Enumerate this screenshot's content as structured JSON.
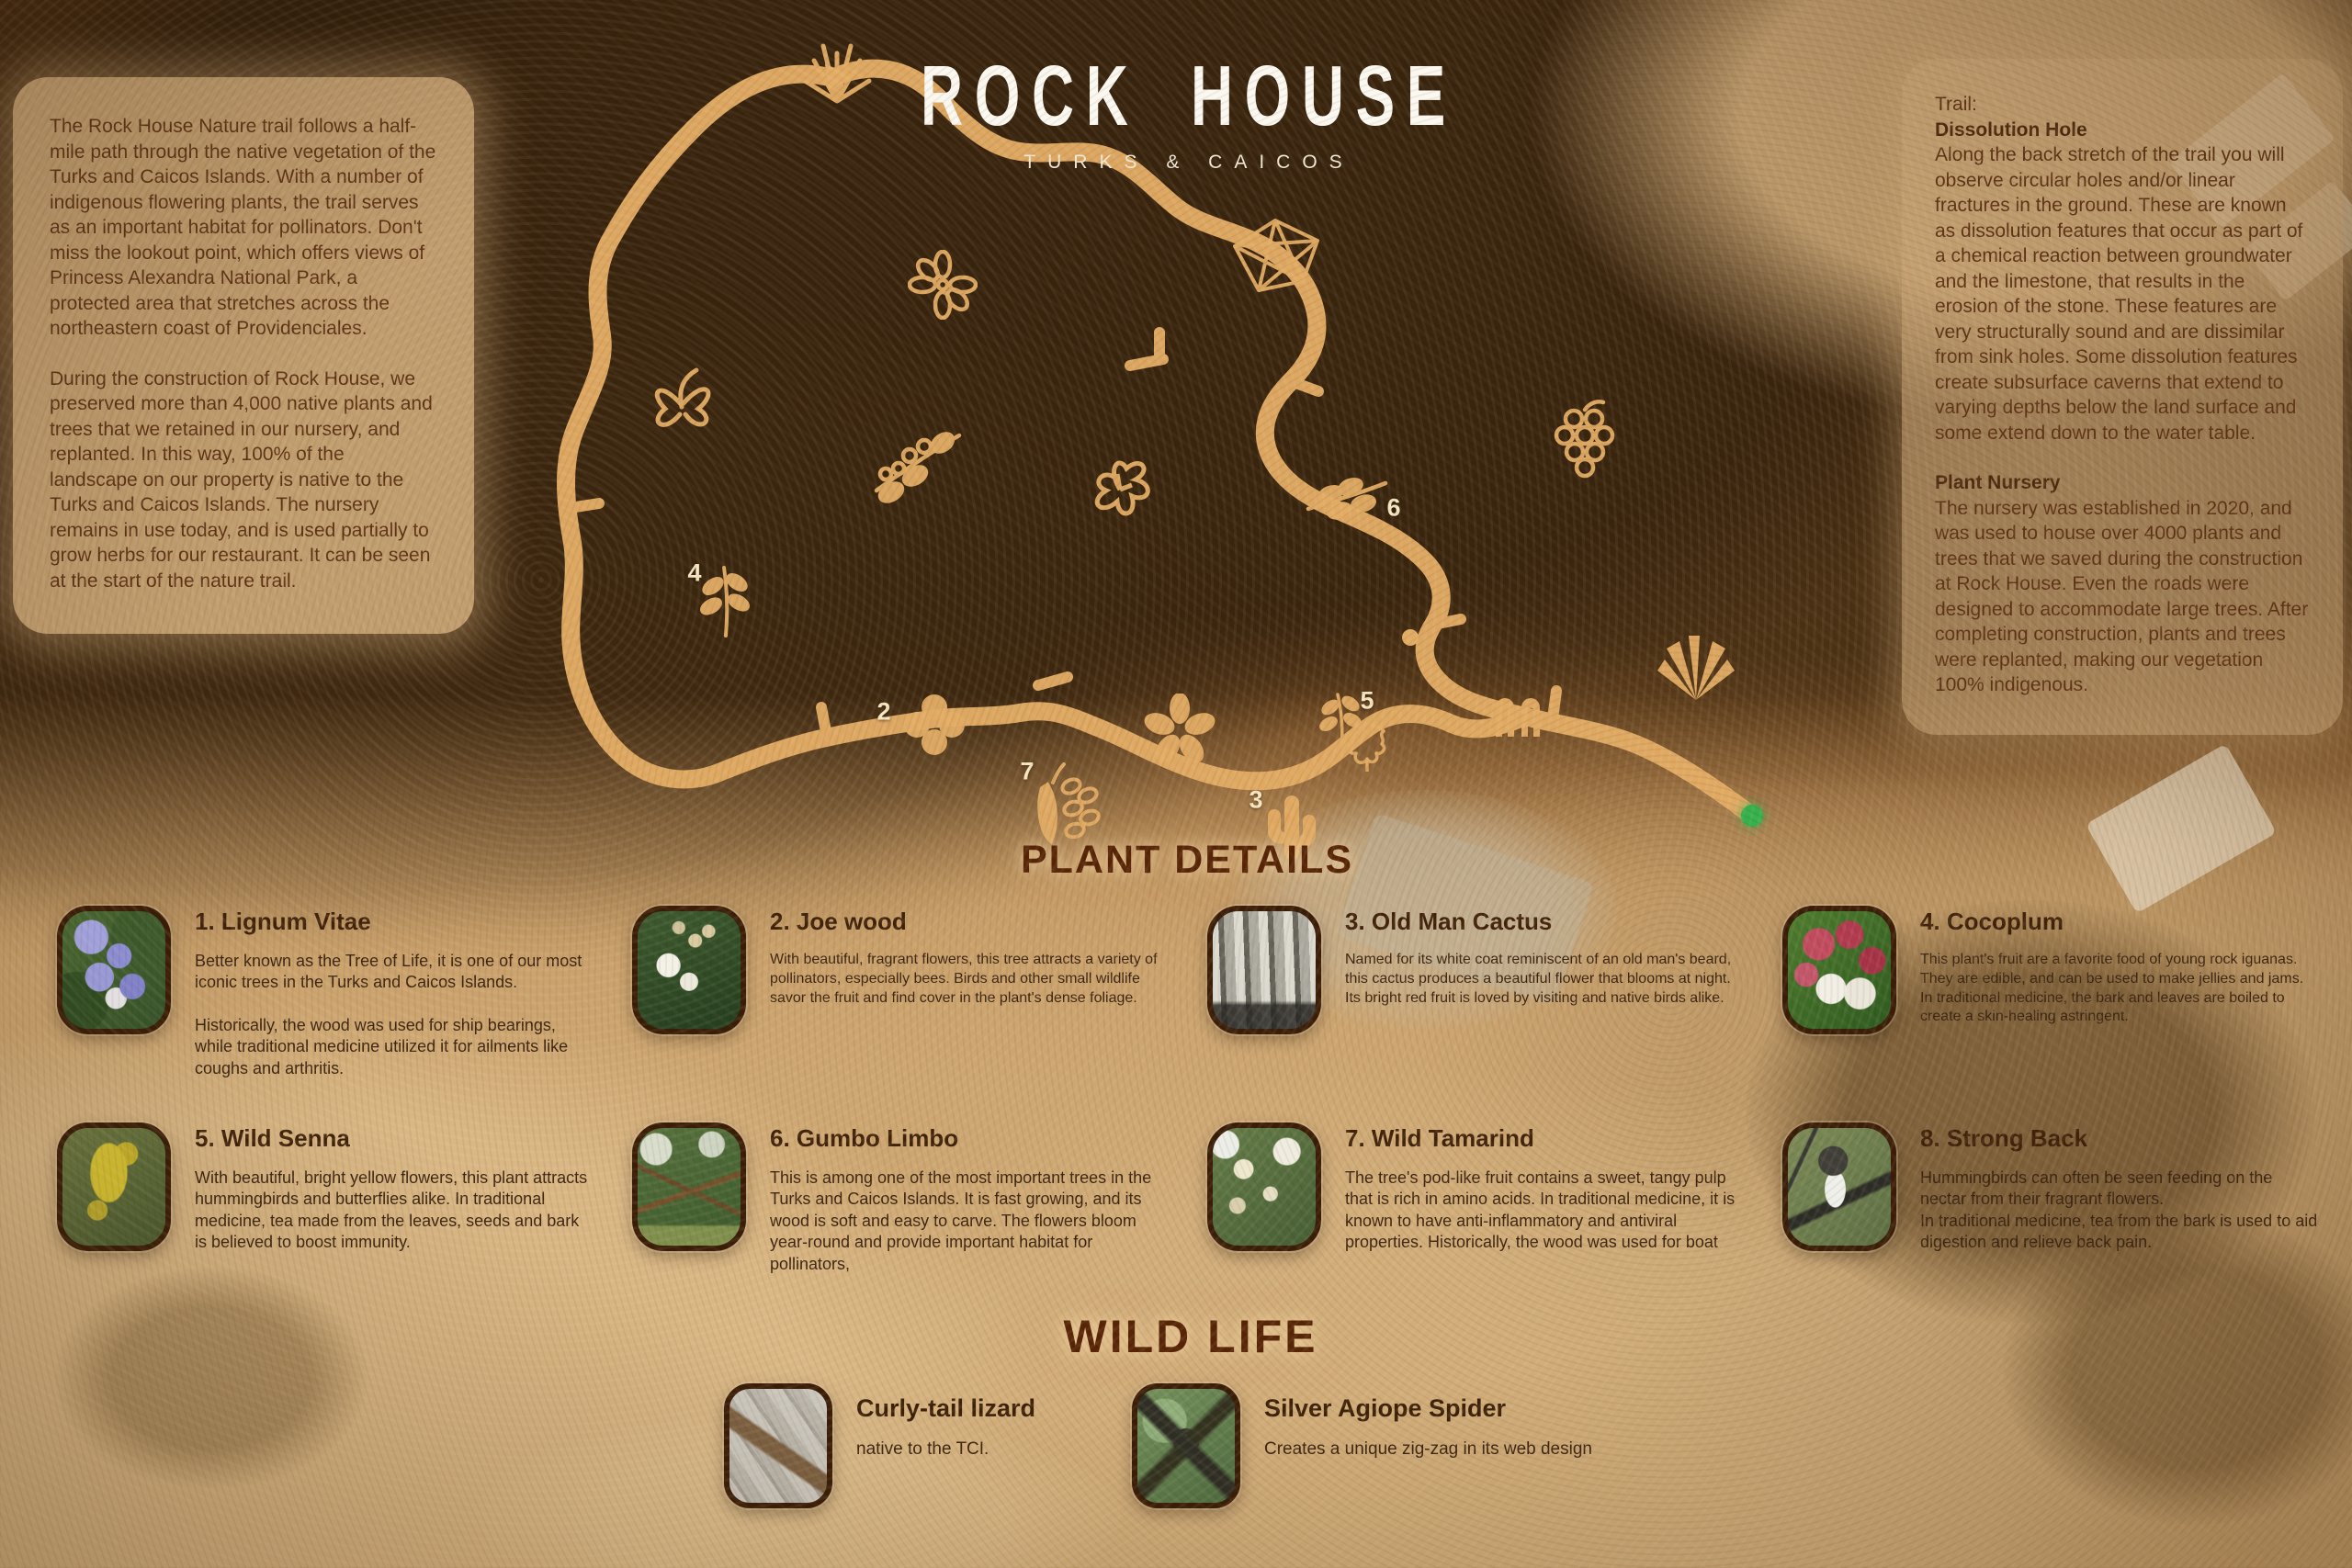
{
  "logo": {
    "title": "ROCK HOUSE",
    "subtitle": "TURKS & CAICOS"
  },
  "intro": {
    "para1": "The Rock House Nature trail follows a half-mile path through the native vegetation of the Turks and Caicos Islands. With a number of indigenous flowering plants, the trail serves as an important habitat for pollinators. Don't miss the lookout point, which offers views of Princess Alexandra National Park, a protected area that stretches across the northeastern coast of Providenciales.",
    "para2": "During the construction of Rock House, we preserved more than 4,000 native plants and trees that we retained in our nursery, and replanted. In this way, 100% of the landscape on our property is native to the Turks and Caicos Islands. The nursery remains in use today, and is used partially to grow herbs for our restaurant. It can be seen at the start of the nature trail."
  },
  "trail_info": {
    "label": "Trail:",
    "sections": [
      {
        "heading": "Dissolution Hole",
        "body": "Along the back stretch of the trail you will observe circular holes and/or linear fractures in the ground. These are known as dissolution features that occur as part of a chemical reaction between groundwater and the limestone, that results in the erosion of the stone. These features are very structurally sound and are dissimilar from sink holes. Some dissolution features create subsurface caverns that extend to varying depths below the land surface and some extend down to the water table."
      },
      {
        "heading": "Plant Nursery",
        "body": "The nursery was established in 2020, and was used to house over 4000 plants and trees that we saved during the construction at Rock House. Even the roads were designed to accommodate large trees. After completing construction, plants and trees were replanted, making our vegetation 100% indigenous."
      }
    ]
  },
  "map": {
    "markers": [
      "2",
      "3",
      "4",
      "5",
      "6",
      "7"
    ],
    "trail_color": "#e3ac64",
    "start_marker_color": "#35b04a"
  },
  "plant_details": {
    "heading": "PLANT DETAILS",
    "plants": [
      {
        "title": "1. Lignum Vitae",
        "description": "Better known as the Tree of Life, it is one of our most iconic trees in the Turks and Caicos Islands.",
        "description2": "Historically, the wood was used for ship bearings, while traditional medicine utilized it for ailments like coughs and arthritis."
      },
      {
        "title": "2. Joe wood",
        "description": "With beautiful, fragrant flowers, this tree attracts a variety of pollinators, especially bees. Birds and other small wildlife savor the fruit and find cover in the plant's dense foliage."
      },
      {
        "title": "3. Old Man Cactus",
        "description": "Named for its white coat reminiscent of an old man's beard, this cactus produces a beautiful flower that blooms at night. Its bright red fruit is loved by visiting and native birds alike."
      },
      {
        "title": "4. Cocoplum",
        "description": "This plant's fruit are a favorite food of young rock iguanas. They are edible, and can be used to make jellies and jams. In traditional medicine, the bark and leaves are boiled to create a skin-healing astringent."
      },
      {
        "title": "5. Wild Senna",
        "description": "With beautiful, bright yellow flowers, this plant attracts hummingbirds and butterflies alike. In traditional medicine, tea made from the leaves, seeds and bark is believed to boost immunity."
      },
      {
        "title": "6. Gumbo Limbo",
        "description": "This is among one of the most important trees in the Turks and Caicos Islands. It is fast growing, and its wood is soft and easy to carve. The flowers bloom year-round and provide important habitat for pollinators,"
      },
      {
        "title": "7. Wild Tamarind",
        "description": "The tree's pod-like fruit contains a sweet, tangy pulp that is rich in amino acids. In traditional medicine, it is known to have anti-inflammatory and antiviral properties. Historically, the wood was used for boat"
      },
      {
        "title": "8. Strong Back",
        "description": "Hummingbirds can often be seen feeding on the nectar from their fragrant flowers.\nIn traditional medicine, tea from the bark is used to aid digestion and relieve back pain."
      }
    ]
  },
  "wildlife": {
    "heading": "WILD LIFE",
    "animals": [
      {
        "title": "Curly-tail lizard",
        "description": "native to the TCI."
      },
      {
        "title": "Silver Agiope Spider",
        "description": "Creates a unique zig-zag in its web design"
      }
    ]
  }
}
